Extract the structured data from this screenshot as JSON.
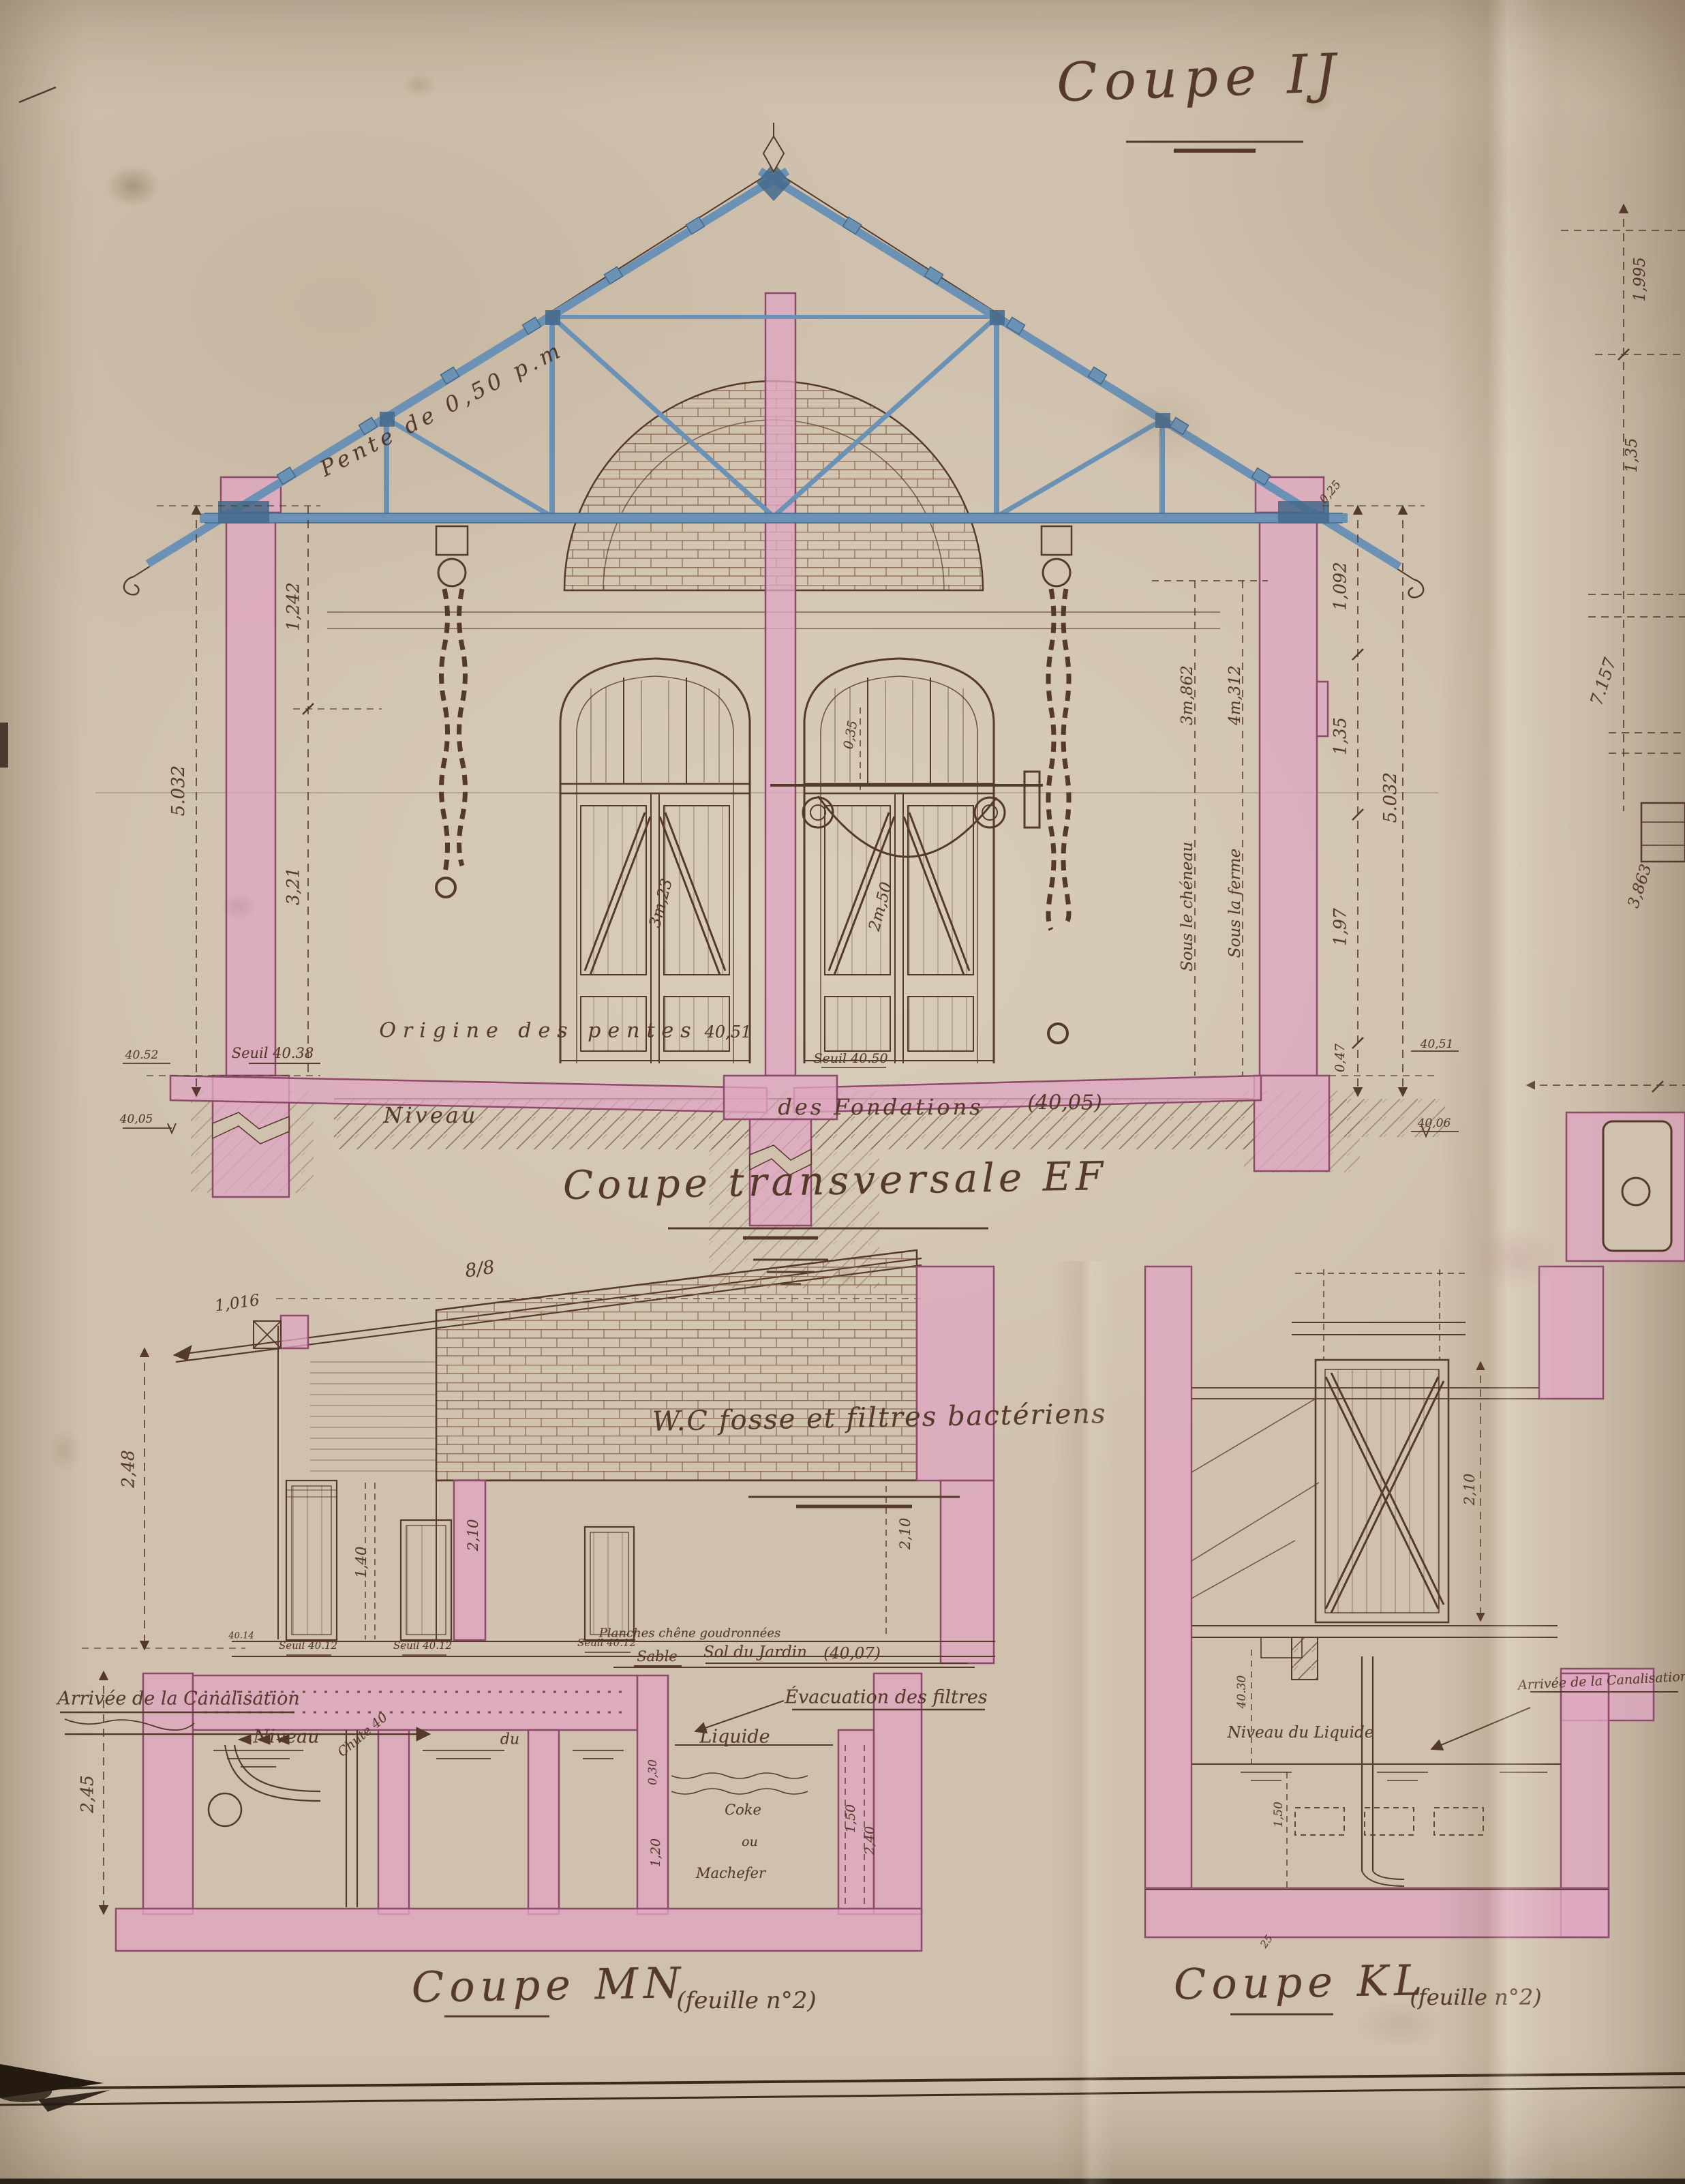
{
  "titles": {
    "sheet": "Coupe IJ",
    "ef": "Coupe transversale EF",
    "mn": "Coupe MN",
    "mn_feuille": "(feuille n°2)",
    "kl": "Coupe KL",
    "kl_feuille": "(feuille n°2)",
    "wc_note": "W.C fosse et filtres bactériens"
  },
  "ef": {
    "pente": "Pente de 0,50 p.m",
    "origine": "Origine des pentes",
    "origine_niveau": "40,51",
    "seuil_gauche": "Seuil 40.38",
    "seuil_milieu": "Seuil 40.50",
    "niveau_mot": "Niveau",
    "niveau_suite": "des Fondations",
    "niveau_cote": "(40,05)",
    "sous_cheneau": "Sous le chéneau",
    "sous_cheneau_cote": "3m,862",
    "sous_ferme": "Sous la ferme",
    "sous_ferme_cote": "4m,312",
    "porte_gauche_cote": "3m,23",
    "porte_droite_cote": "2m,50",
    "imposte_cote": "0,35",
    "dims_gauche": [
      "1,242",
      "3,21",
      "5.032"
    ],
    "niveaux_gauche": [
      "40.52",
      "40,05"
    ],
    "dims_droite": [
      "0,25",
      "1,092",
      "1,35",
      "1,97",
      "0,47",
      "5.032"
    ],
    "niveaux_droite": [
      "40,51",
      "40,06"
    ]
  },
  "bord_droit": {
    "dims": [
      "1,995",
      "1,35",
      "7.157",
      "3,863"
    ]
  },
  "mn": {
    "pente_ratio": "8/8",
    "cote_1016": "1,016",
    "arrivee": "Arrivée de la Canalisation",
    "niveau_mot1": "Niveau",
    "niveau_mot2": "du",
    "niveau_mot3": "Liquide",
    "evacuation": "Évacuation des filtres",
    "planches": "Planches chêne goudronnées",
    "sable": "Sable",
    "sol_jardin": "Sol du Jardin",
    "sol_jardin_cote": "(40,07)",
    "seuils": [
      "Seuil 40.12",
      "Seuil 40.12",
      "Seuil 40.12"
    ],
    "cote_4014": "40.14",
    "chute": "Chute 40",
    "coke_1": "Coke",
    "coke_2": "ou",
    "coke_3": "Machefer",
    "dims": {
      "h_mur": "2,48",
      "h_fosse": "2,45",
      "porte": "1,40",
      "hauteur_a": "2,10",
      "hauteur_b": "2,10",
      "sable_ep": "0,30",
      "coke_ep": "1,20",
      "liquide_h": "1,50",
      "fosse_h": "2,40"
    }
  },
  "kl": {
    "niveau_liquide": "Niveau du Liquide",
    "arrivee": "Arrivée de la Canalisation",
    "dims": {
      "porte": "2,10",
      "niveau": "40.30",
      "liquide": "1,50",
      "dalle": "25"
    }
  },
  "colors": {
    "papier": "#cfc1ad",
    "encre": "#55392a",
    "lavis_rose": "#dfa6c2",
    "rose_fonce": "#8e4a6c",
    "acier_bleu": "#6b92b4",
    "bleu_fonce": "#44688a"
  }
}
